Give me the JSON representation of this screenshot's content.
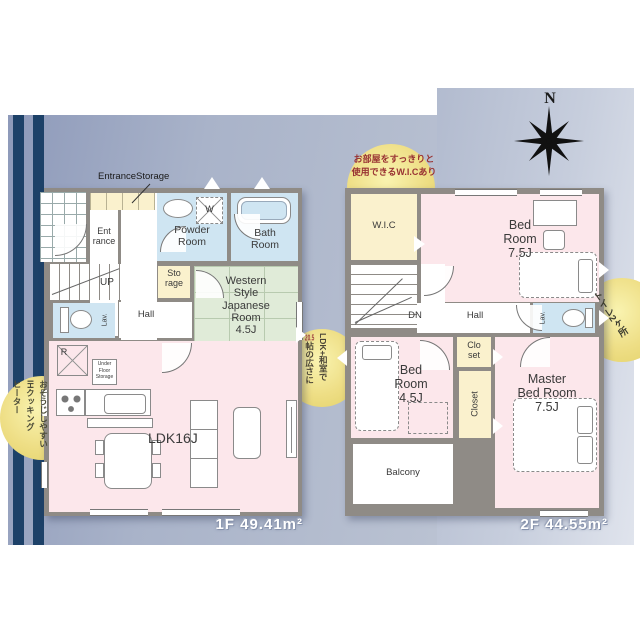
{
  "compass": {
    "north": "N"
  },
  "badges": {
    "ih": {
      "col1": "おそうじしやすい",
      "col2": "IHクッキング",
      "col3": "ヒーター"
    },
    "ldk": {
      "col1": "LDK+和室で",
      "num": "20.5",
      "col2rest": "帖の広さに"
    },
    "wic": {
      "line1": "お部屋をすっきりと",
      "line2": "使用できるW.I.Cあり"
    },
    "toilet": {
      "text": "トイレ2ヶ所"
    }
  },
  "floor1": {
    "area_label": "1F 49.41m²",
    "entrance_storage": "EntranceStorage",
    "rooms": {
      "entrance": "Ent\nrance",
      "powder": "Powder\nRoom",
      "bath": "Bath\nRoom",
      "storage": "Sto\nrage",
      "western": "Western\nStyle\nJapanese\nRoom\n4.5J",
      "up": "UP",
      "hall": "Hall",
      "lav": "Lav.",
      "fridge": "R",
      "washer": "W",
      "underfloor": "Under\nFloor\nStorage",
      "ldk": "LDK16J"
    }
  },
  "floor2": {
    "area_label": "2F 44.55m²",
    "rooms": {
      "wic": "W.I.C",
      "bedroom1": "Bed\nRoom\n7.5J",
      "dn": "DN",
      "hall": "Hall",
      "lav": "Lav.",
      "bedroom2": "Bed\nRoom\n4.5J",
      "closet_upper": "Clo\nset",
      "closet": "Closet",
      "master": "Master\nBed Room\n7.5J",
      "balcony": "Balcony"
    }
  }
}
